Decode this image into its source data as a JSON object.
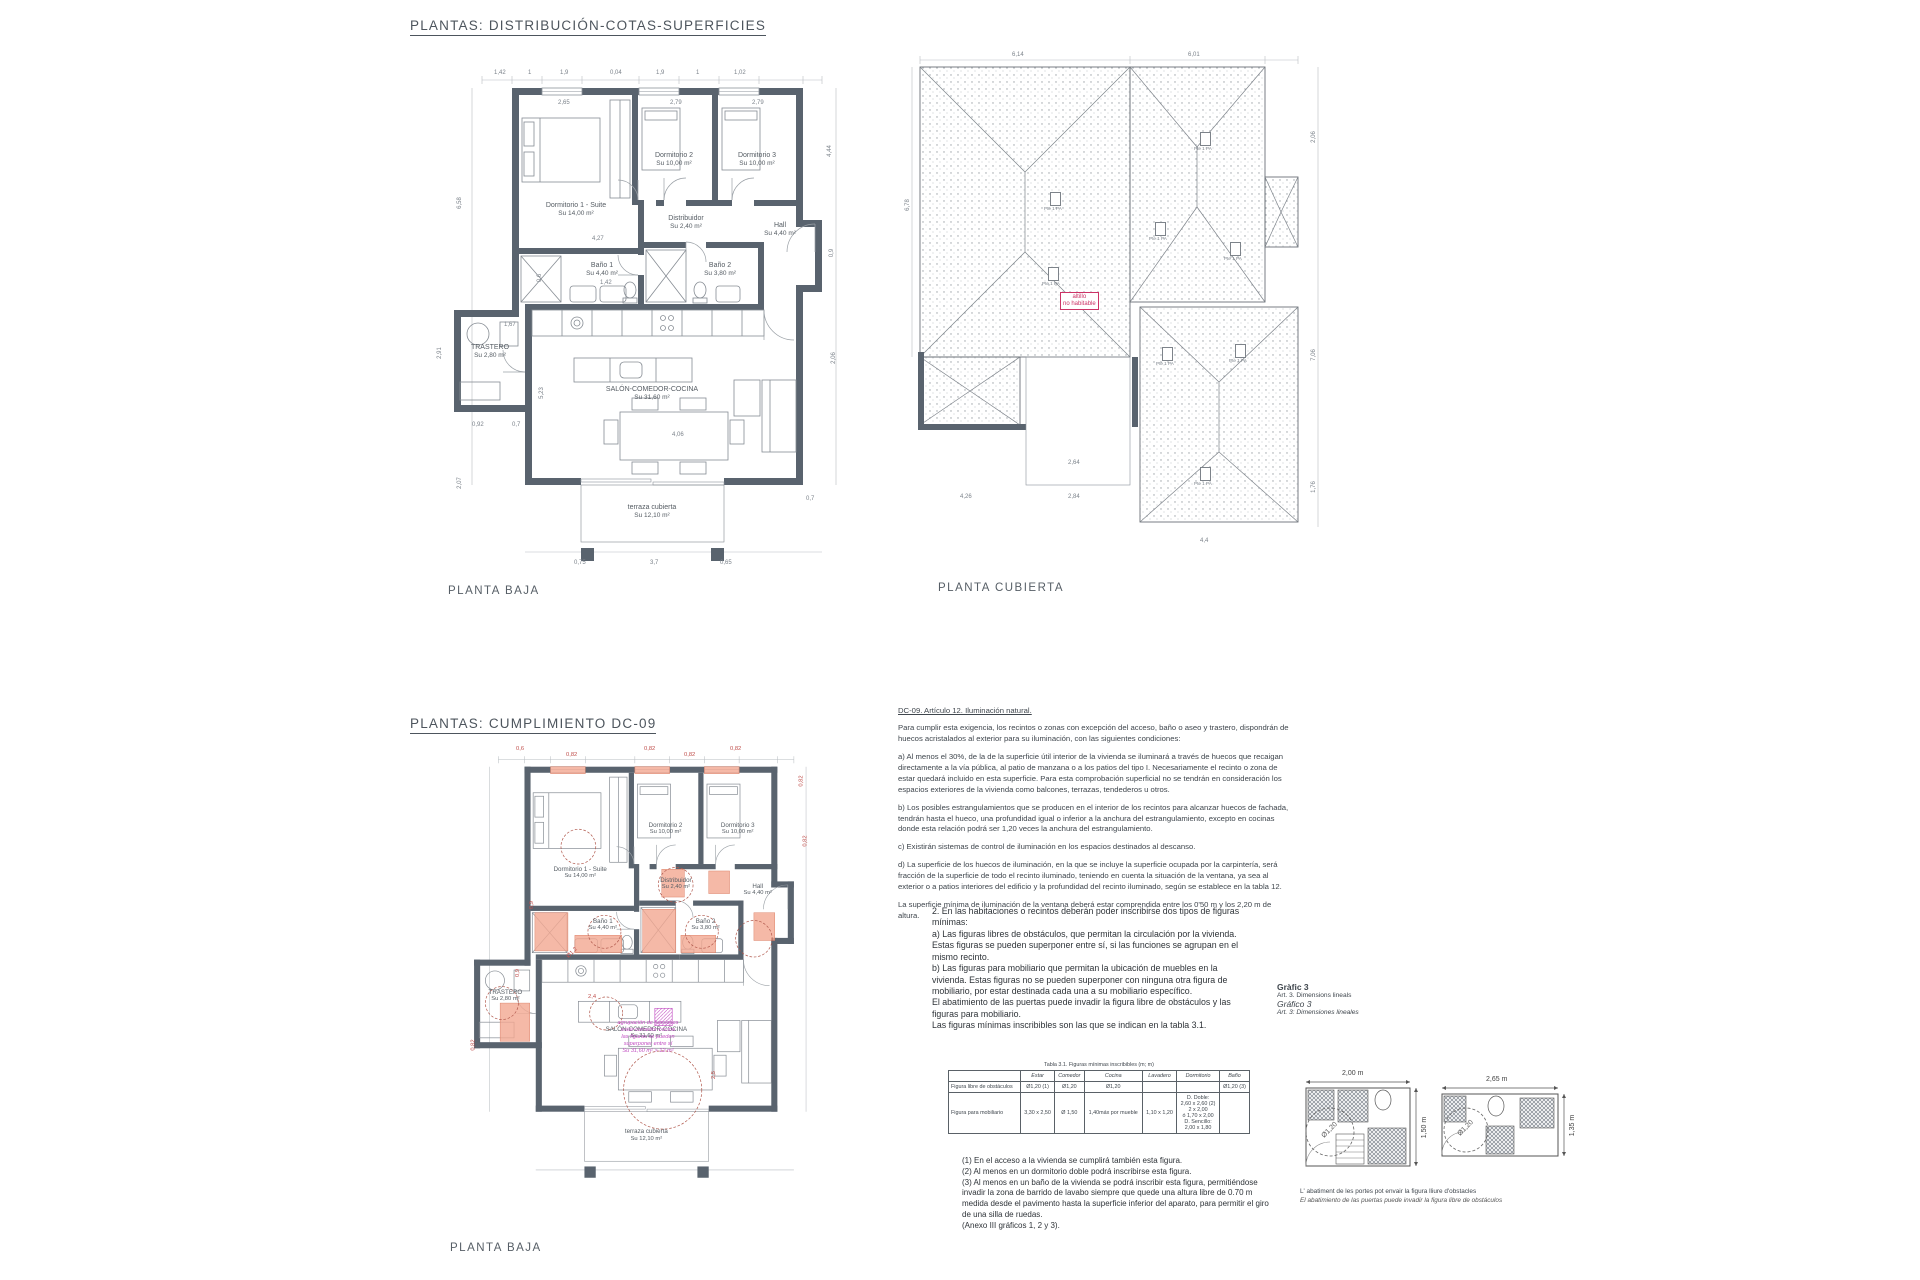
{
  "page": {
    "section1_title": "PLANTAS: DISTRIBUCIÓN-COTAS-SUPERFICIES",
    "section2_title": "PLANTAS: CUMPLIMIENTO DC-09"
  },
  "plan_baja": {
    "caption": "PLANTA BAJA",
    "rooms": [
      {
        "name": "Dormitorio 1 - Suite",
        "area": "Su 14,00 m²",
        "x": 152,
        "y": 150
      },
      {
        "name": "Dormitorio 2",
        "area": "Su 10,00 m²",
        "x": 250,
        "y": 100
      },
      {
        "name": "Dormitorio 3",
        "area": "Su 10,00 m²",
        "x": 333,
        "y": 100
      },
      {
        "name": "Distribuidor",
        "area": "Su 2,40 m²",
        "x": 262,
        "y": 163
      },
      {
        "name": "Baño 1",
        "area": "Su 4,40 m²",
        "x": 178,
        "y": 210
      },
      {
        "name": "Baño 2",
        "area": "Su 3,80 m²",
        "x": 296,
        "y": 210
      },
      {
        "name": "Hall",
        "area": "Su 4,40 m²",
        "x": 356,
        "y": 170
      },
      {
        "name": "TRASTERO",
        "area": "Su 2,80 m²",
        "x": 66,
        "y": 292
      },
      {
        "name": "SALÓN-COMEDOR-COCINA",
        "area": "Su 31,60 m²",
        "x": 228,
        "y": 334
      },
      {
        "name": "terraza cubierta",
        "area": "Su 12,10 m²",
        "x": 228,
        "y": 452
      }
    ],
    "dims": [
      {
        "t": "1,42",
        "x": 70,
        "y": 10
      },
      {
        "t": "1",
        "x": 104,
        "y": 10
      },
      {
        "t": "1,9",
        "x": 136,
        "y": 10
      },
      {
        "t": "0,04",
        "x": 186,
        "y": 10
      },
      {
        "t": "1,9",
        "x": 232,
        "y": 10
      },
      {
        "t": "1",
        "x": 272,
        "y": 10
      },
      {
        "t": "1,02",
        "x": 310,
        "y": 10
      },
      {
        "t": "2,65",
        "x": 134,
        "y": 40
      },
      {
        "t": "2,79",
        "x": 246,
        "y": 40
      },
      {
        "t": "2,79",
        "x": 328,
        "y": 40
      },
      {
        "t": "6,58",
        "x": 30,
        "y": 140,
        "r": -90
      },
      {
        "t": "2,91",
        "x": 10,
        "y": 290,
        "r": -90
      },
      {
        "t": "2,07",
        "x": 30,
        "y": 420,
        "r": -90
      },
      {
        "t": "4,44",
        "x": 400,
        "y": 88,
        "r": -90
      },
      {
        "t": "0,9",
        "x": 404,
        "y": 190,
        "r": -90
      },
      {
        "t": "2,06",
        "x": 404,
        "y": 295,
        "r": -90
      },
      {
        "t": "4,27",
        "x": 168,
        "y": 176
      },
      {
        "t": "1,42",
        "x": 176,
        "y": 220
      },
      {
        "t": "0,6",
        "x": 112,
        "y": 215,
        "r": -90
      },
      {
        "t": "1,67",
        "x": 80,
        "y": 262
      },
      {
        "t": "0,92",
        "x": 48,
        "y": 362
      },
      {
        "t": "0,7",
        "x": 88,
        "y": 362
      },
      {
        "t": "4,06",
        "x": 248,
        "y": 372
      },
      {
        "t": "5,23",
        "x": 112,
        "y": 330,
        "r": -90
      },
      {
        "t": "0,75",
        "x": 150,
        "y": 500
      },
      {
        "t": "3,7",
        "x": 226,
        "y": 500
      },
      {
        "t": "0,65",
        "x": 296,
        "y": 500
      },
      {
        "t": "0,7",
        "x": 382,
        "y": 436
      }
    ]
  },
  "plan_cubierta": {
    "caption": "PLANTA CUBIERTA",
    "slope_label": "Pte 1 PA",
    "slopes": [
      {
        "x": 150,
        "y": 140
      },
      {
        "x": 300,
        "y": 80
      },
      {
        "x": 255,
        "y": 170
      },
      {
        "x": 330,
        "y": 190
      },
      {
        "x": 148,
        "y": 215
      },
      {
        "x": 262,
        "y": 295
      },
      {
        "x": 335,
        "y": 292
      },
      {
        "x": 300,
        "y": 415
      }
    ],
    "note": [
      "altillo",
      "no habitable"
    ],
    "dims": [
      {
        "t": "6,14",
        "x": 112,
        "y": 0
      },
      {
        "t": "6,01",
        "x": 288,
        "y": 0
      },
      {
        "t": "6,78",
        "x": 2,
        "y": 150,
        "r": -90
      },
      {
        "t": "2,06",
        "x": 408,
        "y": 82,
        "r": -90
      },
      {
        "t": "7,06",
        "x": 408,
        "y": 300,
        "r": -90
      },
      {
        "t": "1,76",
        "x": 408,
        "y": 432,
        "r": -90
      },
      {
        "t": "4,26",
        "x": 60,
        "y": 442
      },
      {
        "t": "2,84",
        "x": 168,
        "y": 442
      },
      {
        "t": "4,4",
        "x": 300,
        "y": 486
      },
      {
        "t": "2,64",
        "x": 168,
        "y": 408
      }
    ]
  },
  "plan_dc09": {
    "caption": "PLANTA BAJA",
    "label_scale": 0.87,
    "red_dims": [
      {
        "t": "0,6",
        "x": 68,
        "y": 4
      },
      {
        "t": "0,82",
        "x": 118,
        "y": 10
      },
      {
        "t": "0,82",
        "x": 196,
        "y": 4
      },
      {
        "t": "0,82",
        "x": 236,
        "y": 10
      },
      {
        "t": "0,82",
        "x": 282,
        "y": 4
      },
      {
        "t": "0,82",
        "x": 348,
        "y": 36,
        "r": -90
      },
      {
        "t": "0,82",
        "x": 352,
        "y": 96,
        "r": -90
      },
      {
        "t": "0,9",
        "x": 66,
        "y": 228,
        "r": -90
      },
      {
        "t": "Ø1,2",
        "x": 118,
        "y": 208,
        "r": -45
      },
      {
        "t": "2,4",
        "x": 140,
        "y": 252
      },
      {
        "t": "0,82",
        "x": 20,
        "y": 300,
        "r": -90
      },
      {
        "t": "2,5",
        "x": 262,
        "y": 330,
        "r": -90
      },
      {
        "t": "0,9",
        "x": 80,
        "y": 160,
        "r": -90
      }
    ],
    "magenta_note": [
      "agrupación de funciones",
      "estar-comedor-cocina",
      "las figuras se pueden",
      "superponer entre sí",
      "Su 31,60 m² > 12 m²"
    ]
  },
  "dc09_text": {
    "heading": "DC-09. Artículo 12. Iluminación natural.",
    "intro": "Para cumplir esta exigencia, los recintos o zonas con excepción del acceso, baño o aseo y trastero, dispondrán de huecos acristalados al exterior para su iluminación, con las siguientes condiciones:",
    "paragraphs": [
      "a) Al menos el 30%, de la de la superficie útil interior de la vivienda se iluminará a través de huecos que recaigan directamente a la vía pública, al patio de manzana o a los patios del tipo I. Necesariamente el recinto o zona de estar quedará incluido en esta superficie. Para esta comprobación superficial no se tendrán en consideración los espacios exteriores de la vivienda como balcones, terrazas, tendederos u otros.",
      "b) Los posibles estrangulamientos que se producen en el interior de los recintos para alcanzar huecos de fachada, tendrán hasta el hueco, una profundidad igual o inferior a la anchura del estrangulamiento, excepto en cocinas donde esta relación podrá ser 1,20 veces la anchura del estrangulamiento.",
      "c) Existirán sistemas de control de iluminación en los espacios destinados al descanso.",
      "d) La superficie de los huecos de iluminación, en la que se incluye la superficie ocupada por la carpintería, será fracción de la superficie de todo el recinto iluminado, teniendo en cuenta la situación de la ventana, ya sea al exterior o a patios interiores del edificio y la profundidad del recinto iluminado, según se establece en la tabla 12.",
      "La superficie mínima de iluminación de la ventana deberá estar comprendida entre los 0'50 m y los 2,20 m de altura."
    ]
  },
  "figuras_text": {
    "paragraphs": [
      "2. En las habitaciones o recintos deberán poder inscribirse dos tipos de figuras mínimas:",
      "a) Las figuras libres de obstáculos, que permitan la circulación por la vivienda. Estas figuras se pueden superponer entre sí, si las funciones se agrupan en el mismo recinto.",
      "b) Las figuras para mobiliario que permitan la ubicación de muebles en la vivienda. Estas figuras no se pueden superponer con ninguna otra figura de mobiliario, por estar destinada cada una a su mobiliario específico.",
      "El abatimiento de las puertas puede invadir la figura libre de obstáculos y las figuras para mobiliario.",
      "Las figuras mínimas inscribibles son las que se indican en la tabla 3.1."
    ]
  },
  "grafico": {
    "lines": [
      "Gràfic 3",
      "Art. 3. Dimensions lineals",
      "Gráfico 3",
      "Art. 3: Dimensiones lineales"
    ]
  },
  "tabla": {
    "title": "Tabla 3.1. Figuras mínimas inscribibles (m; m)",
    "headers": [
      "",
      "Estar",
      "Comedor",
      "Cocina",
      "Lavadero",
      "Dormitorio",
      "Baño"
    ],
    "rows": [
      [
        "Figura libre de obstáculos",
        "Ø1,20 (1)",
        "Ø1,20",
        "Ø1,20",
        "",
        "",
        "Ø1,20 (3)"
      ],
      [
        "Figura para mobiliario",
        "3,30 x 2,50",
        "Ø 1,50",
        "1,40máx por mueble",
        "1,10 x 1,20",
        "D. Doble:\n2,60 x 2,60 (2)\n2 x 2,00\nó 1,70 x 2,00\nD. Sencillo:\n2,00 x 1,80",
        ""
      ]
    ]
  },
  "footnotes": [
    "(1) En el acceso a la vivienda se cumplirá también esta figura.",
    "(2) Al menos en un dormitorio doble podrá inscribirse esta figura.",
    "(3) Al menos en un baño de la vivienda se podrá inscribir esta figura, permitiéndose invadir la zona de barrido de lavabo siempre que quede una altura libre de 0.70 m medida desde el pavimento hasta la superficie inferior del aparato, para permitir el giro de una silla de ruedas.",
    "(Anexo III gráficos 1, 2 y 3)."
  ],
  "diagrams": {
    "left": {
      "width_label": "2,00 m",
      "height_label": "1,50 m",
      "circle_label": "Ø1,20"
    },
    "right": {
      "width_label": "2,65 m",
      "height_label": "1,35 m",
      "circle_label": "Ø1,20"
    },
    "caption": [
      "L' abatiment de les portes pot envair la figura lliure d'obstacles",
      "El abatimiento de las puertas puede invadir la figura libre de obstáculos"
    ]
  },
  "colors": {
    "wall": "#59636e",
    "line": "#8d939b",
    "highlight": "#f2a791",
    "red": "#c0504d",
    "magenta": "#c24fc2"
  }
}
